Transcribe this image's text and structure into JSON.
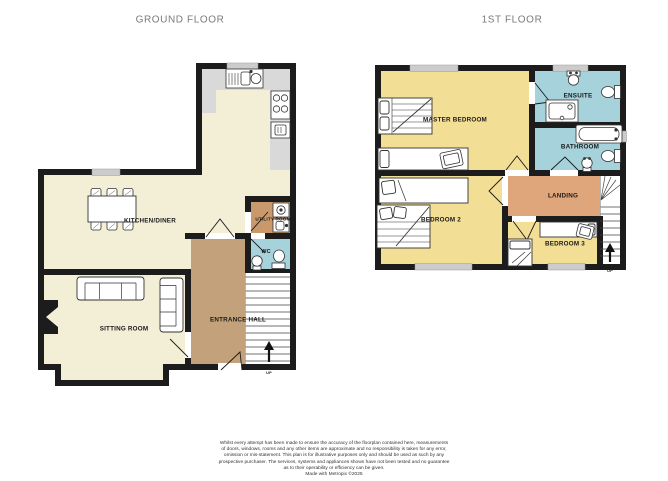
{
  "colors": {
    "wall": "#1c1c1c",
    "cream_floor": "#f3eed6",
    "yellow_floor": "#f2de94",
    "blue_floor": "#a6d2db",
    "hall_brown": "#c2a17b",
    "utility_brown": "#c9996b",
    "landing_orange": "#dfa57b",
    "counter_gray": "#d9d9d9",
    "window_gray": "#cccccc",
    "title_gray": "#7a7a7a"
  },
  "floors": {
    "ground": {
      "title": "GROUND FLOOR",
      "rooms": {
        "kitchen_diner": "KITCHEN/DINER",
        "utility_room": "UTILITY ROOM",
        "wc": "WC",
        "sitting_room": "SITTING ROOM",
        "entrance_hall": "ENTRANCE HALL"
      },
      "stairs_label": "UP"
    },
    "first": {
      "title": "1ST FLOOR",
      "rooms": {
        "master_bedroom": "MASTER BEDROOM",
        "ensuite": "ENSUITE",
        "bathroom": "BATHROOM",
        "landing": "LANDING",
        "bedroom_2": "BEDROOM 2",
        "bedroom_3": "BEDROOM 3"
      },
      "stairs_label": "UP"
    }
  },
  "disclaimer": {
    "lines": [
      "Whilst every attempt has been made to ensure the accuracy of the floorplan contained here, measurements",
      "of doors, windows, rooms and any other items are approximate and no responsibility is taken for any error,",
      "omission or mis-statement. This plan is for illustrative purposes only and should be used as such by any",
      "prospective purchaser. The services, systems and appliances shown have not been tested and no guarantee",
      "as to their operability or efficiency can be given.",
      "Made with Metropix ©2025"
    ]
  }
}
